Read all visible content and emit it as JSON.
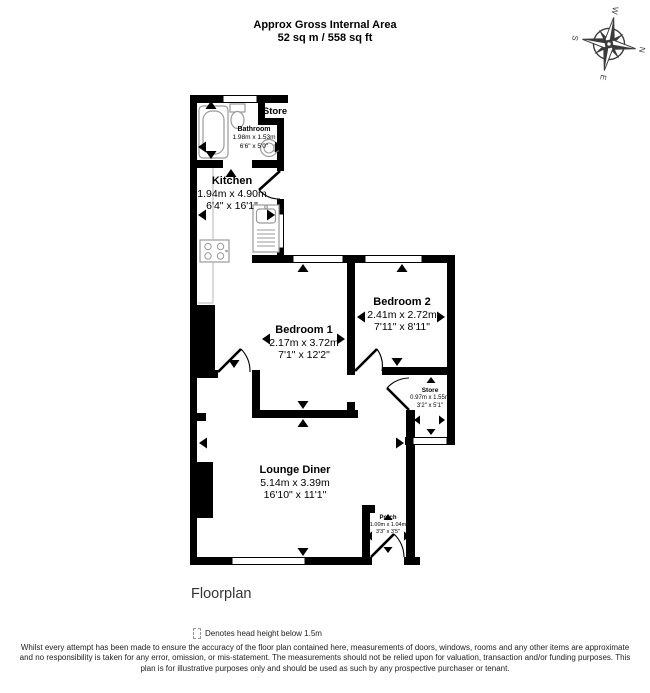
{
  "header": {
    "title_line1": "Approx Gross Internal Area",
    "title_line2": "52 sq m / 558 sq ft"
  },
  "compass": {
    "n": "N",
    "e": "E",
    "s": "S",
    "w": "W"
  },
  "rooms": {
    "bathroom": {
      "name": "Bathroom",
      "metric": "1.98m x 1.53m",
      "imperial": "6'6\" x 5'0\""
    },
    "store_top": {
      "name": "Store"
    },
    "kitchen": {
      "name": "Kitchen",
      "metric": "1.94m x 4.90m",
      "imperial": "6'4\" x 16'1\""
    },
    "bedroom1": {
      "name": "Bedroom 1",
      "metric": "2.17m x 3.72m",
      "imperial": "7'1\" x 12'2\""
    },
    "bedroom2": {
      "name": "Bedroom 2",
      "metric": "2.41m x 2.72m",
      "imperial": "7'11\" x 8'11\""
    },
    "store": {
      "name": "Store",
      "metric": "0.97m x 1.55m",
      "imperial": "3'2\" x 5'1\""
    },
    "lounge": {
      "name": "Lounge Diner",
      "metric": "5.14m x 3.39m",
      "imperial": "16'10\" x 11'1\""
    },
    "porch": {
      "name": "Porch",
      "metric": "1.00m x 1.04m",
      "imperial": "3'3\" x 3'5\""
    }
  },
  "caption": "Floorplan",
  "legend": {
    "text": "Denotes head height below 1.5m"
  },
  "disclaimer": "Whilst every attempt has been made to ensure the accuracy of the floor plan contained here, measurements of doors, windows, rooms and any other items are approximate and no responsibility is taken for any error, omission, or mis-statement. The measurements should not be relied upon for valuation, transaction and/or funding purposes. This plan is for illustrative purposes only and should be used as such by any prospective purchaser or tenant.",
  "fixtures": [
    "bathtub",
    "toilet",
    "basin",
    "kitchen-sink",
    "hob"
  ],
  "colors": {
    "wall": "#000000",
    "background": "#ffffff",
    "fixture_outline": "#9a9a9a",
    "text": "#000000"
  }
}
